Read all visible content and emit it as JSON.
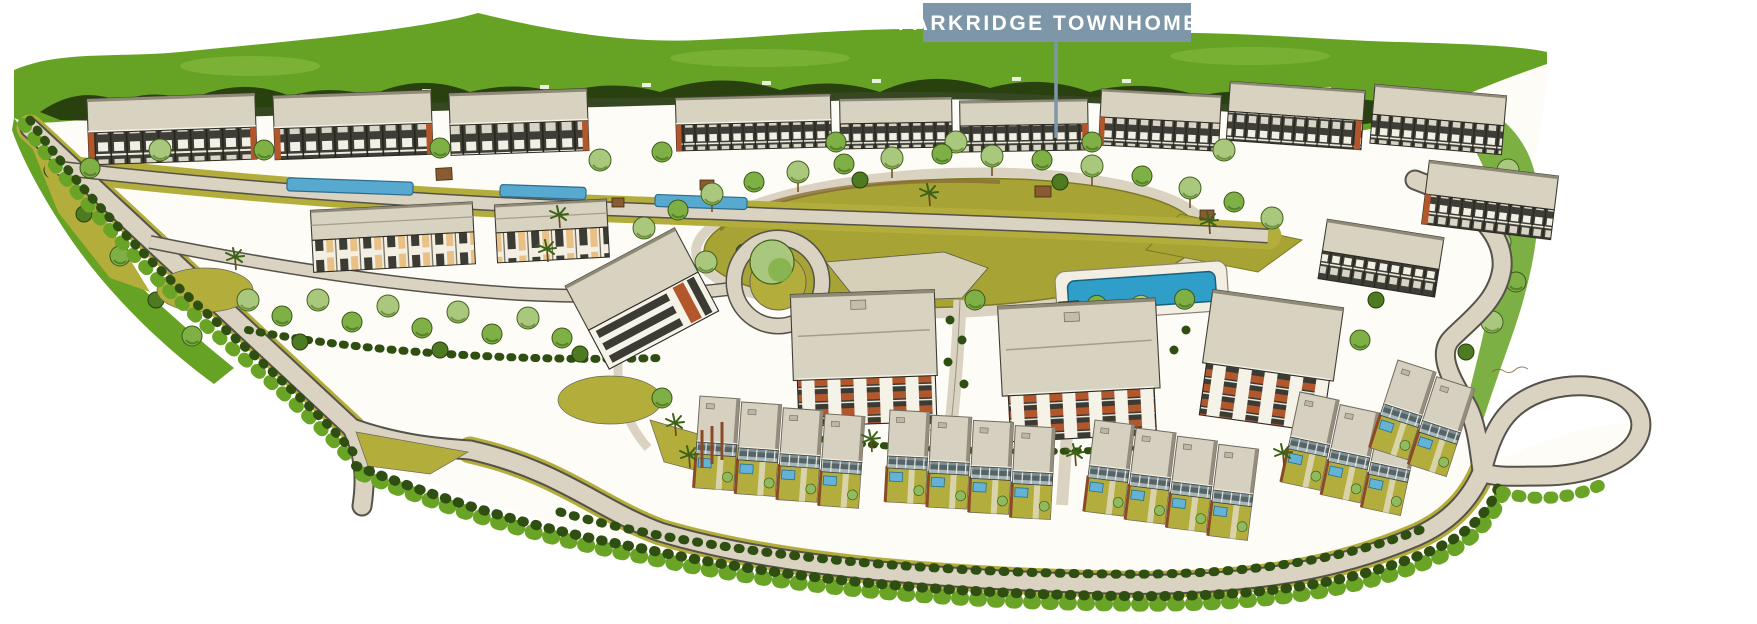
{
  "label": {
    "text": "PARKRIDGE TOWNHOMES",
    "bg_color": "#7e97a8",
    "text_color": "#ffffff",
    "leader_color": "#7e97a8"
  },
  "palette": {
    "canopy_green": "#66a223",
    "canopy_dark": "#24380e",
    "foliage_light": "#a9c87e",
    "foliage_mid": "#7fb045",
    "foliage_dark": "#4e7a22",
    "hedge_dark": "#2f4e12",
    "lawn_olive": "#a7a334",
    "verge_olive": "#b3ad3c",
    "roof_tan": "#d8d2c1",
    "road_beige": "#dad3c1",
    "ink_outline": "#55524a",
    "window_band_dark": "#3e3e36",
    "accent_rust": "#b2562c",
    "panel_cream": "#e9c187",
    "pool_blue": "#2f9fca",
    "canal_blue": "#58a9cf",
    "paper": "#fdfcf7"
  }
}
